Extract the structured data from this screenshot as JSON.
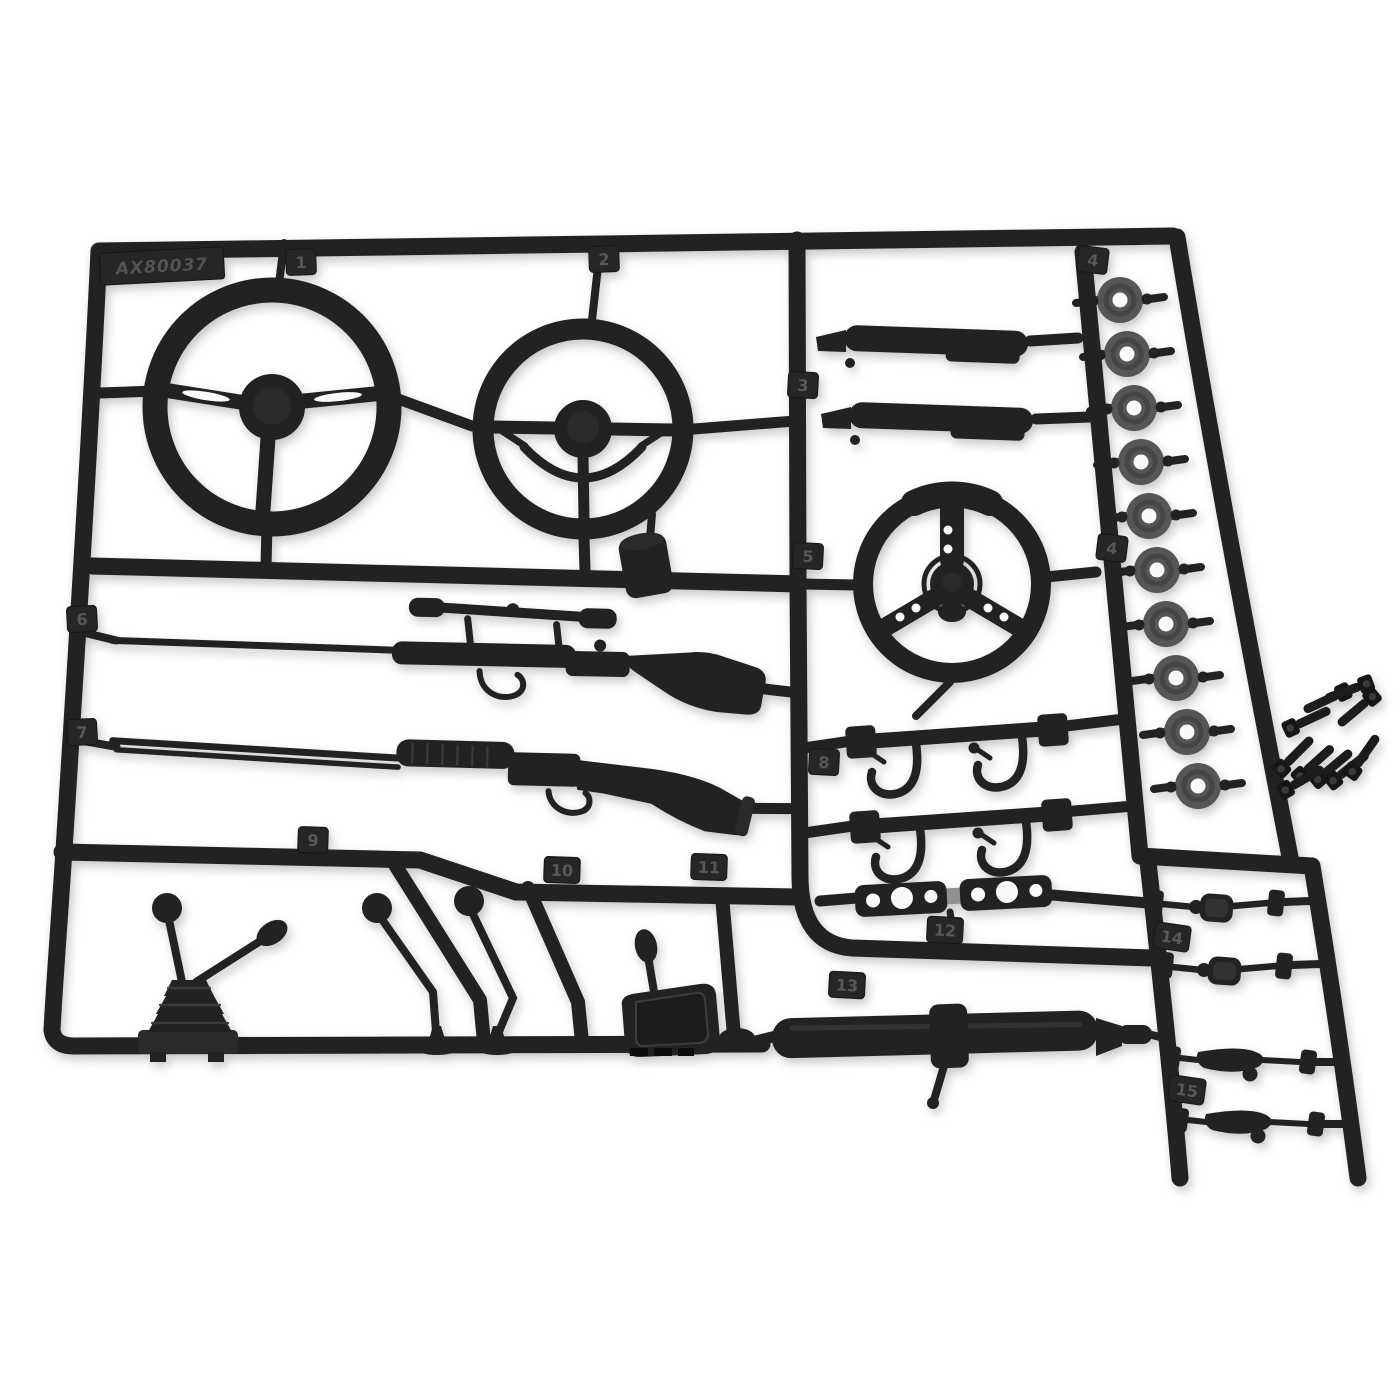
{
  "photo": {
    "subject": "Black injection-molded plastic parts tree (sprue) of scale vehicle interior accessory parts with loose cap screws, on a white background",
    "background_color": "#ffffff",
    "plastic_color": "#242424",
    "washer_color": "#575757"
  },
  "sprue": {
    "part_number": "AX80037",
    "washer_count": 10,
    "loose_screw_count": 10,
    "tags": [
      {
        "label": "1",
        "part": "classic slotted 3-spoke steering wheel"
      },
      {
        "label": "2",
        "part": "vintage steering wheel with horn ring"
      },
      {
        "label": "3",
        "part": "door armrest handles (pair)"
      },
      {
        "label": "4",
        "part": "round washers"
      },
      {
        "label": "5",
        "part": "sport 3-spoke steering wheel"
      },
      {
        "label": "6",
        "part": "scoped bolt-action rifle"
      },
      {
        "label": "7",
        "part": "pump shotgun"
      },
      {
        "label": "8",
        "part": "mount bars with utility hooks (pair)"
      },
      {
        "label": "9",
        "part": "dual-stick transfer-case shifter with boot"
      },
      {
        "label": "10",
        "part": "bent shift levers with ball knobs"
      },
      {
        "label": "11",
        "part": "automatic shifter console"
      },
      {
        "label": "12",
        "part": "three-hole bracket plates (pair)"
      },
      {
        "label": "13",
        "part": "steering column with stalk"
      },
      {
        "label": "14",
        "part": "side mirrors (pair)"
      },
      {
        "label": "15",
        "part": "door handles (pair)"
      }
    ]
  }
}
